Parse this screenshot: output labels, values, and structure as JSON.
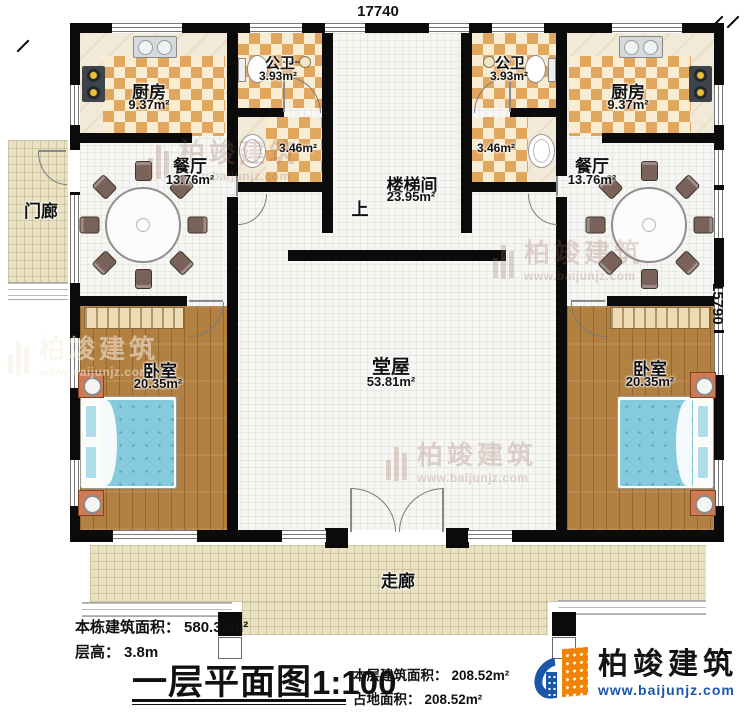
{
  "plan": {
    "dimensions": {
      "top": "17740",
      "right": "15790"
    },
    "rooms": {
      "kitchen_left": {
        "name": "厨房",
        "area": "9.37m²"
      },
      "kitchen_right": {
        "name": "厨房",
        "area": "9.37m²"
      },
      "bath_left": {
        "name": "公卫",
        "area": "3.93m²"
      },
      "bath_right": {
        "name": "公卫",
        "area": "3.93m²"
      },
      "wash_left": {
        "area": "3.46m²"
      },
      "wash_right": {
        "area": "3.46m²"
      },
      "dining_left": {
        "name": "餐厅",
        "area": "13.76m²"
      },
      "dining_right": {
        "name": "餐厅",
        "area": "13.76m²"
      },
      "stairwell": {
        "name": "楼梯间",
        "area": "23.95m²",
        "direction": "上"
      },
      "shrine": {
        "name": "神龛"
      },
      "hall": {
        "name": "堂屋",
        "area": "53.81m²"
      },
      "bedroom_left": {
        "name": "卧室",
        "area": "20.35m²"
      },
      "bedroom_right": {
        "name": "卧室",
        "area": "20.35m²"
      },
      "porch": {
        "name": "门廊"
      },
      "corridor": {
        "name": "走廊"
      }
    },
    "notes": {
      "building_area_label": "本栋建筑面积：",
      "building_area_value": "580.32m²",
      "floor_height_label": "层高：",
      "floor_height_value": "3.8m",
      "floor_area_label": "本层建筑面积：",
      "floor_area_value": "208.52m²",
      "footprint_label": "占地面积：",
      "footprint_value": "208.52m²"
    },
    "title": {
      "main": "一层平面图",
      "scale": "1:100"
    }
  },
  "branding": {
    "logo_name": "柏竣建筑",
    "logo_url": "www.baijunjz.com",
    "watermark_text": "柏竣建筑",
    "watermark_url": "www.baijunjz.com"
  },
  "colors": {
    "wall": "#0b0b0b",
    "checker_orange": "#e2a75f",
    "checker_cream": "#f8edd2",
    "wood_floor": "#b28040",
    "corridor_tile": "#eae1c2",
    "bed_blue": "#85cadd",
    "nightstand_orange": "#cf7a52",
    "shrine_wood": "#c8873f",
    "logo_blue": "#1a56a8",
    "logo_orange": "#f08300"
  }
}
